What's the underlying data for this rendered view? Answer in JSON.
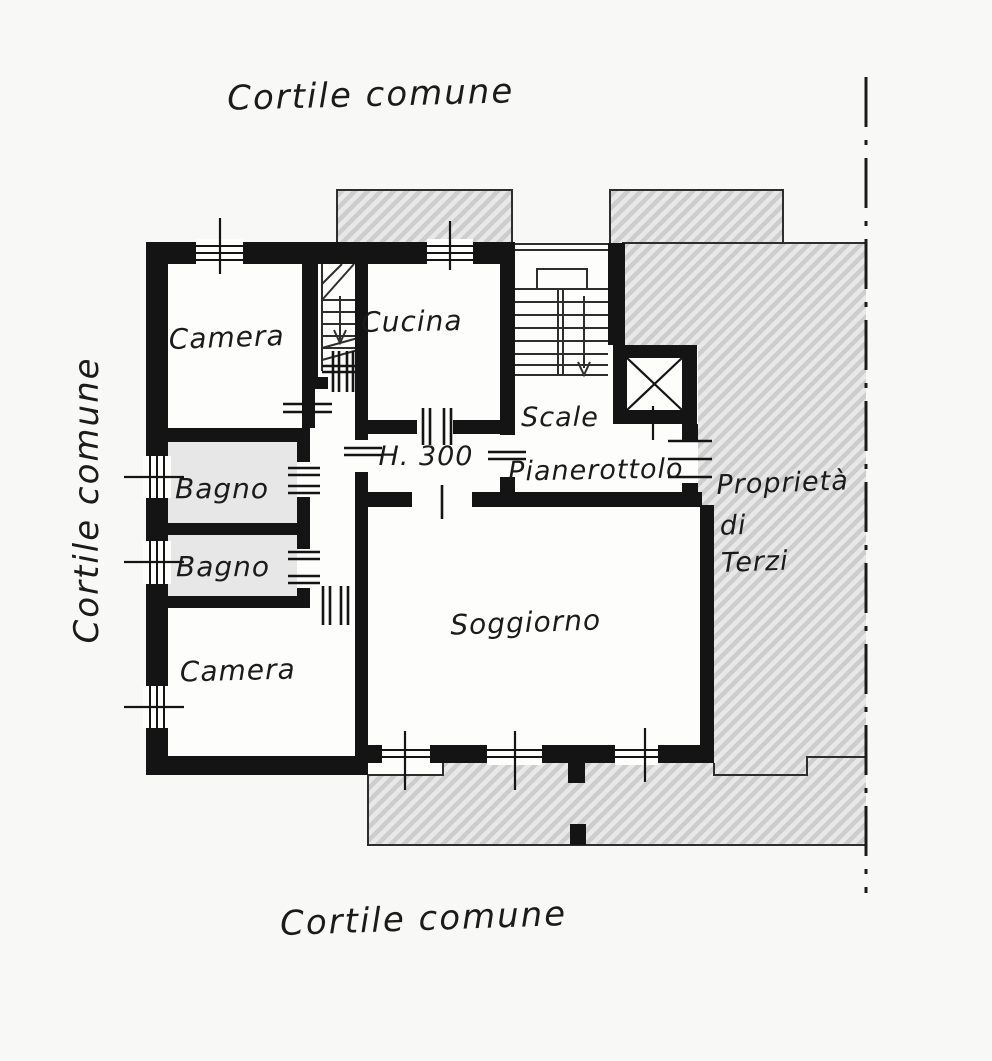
{
  "labels": {
    "cortile_top": "Cortile comune",
    "cortile_left": "Cortile comune",
    "cortile_bottom": "Cortile comune",
    "camera_top": "Camera",
    "cucina": "Cucina",
    "bagno_top": "Bagno",
    "bagno_bottom": "Bagno",
    "camera_bottom": "Camera",
    "soggiorno": "Soggiorno",
    "scale": "Scale",
    "pianerottolo": "Pianerottolo",
    "height_note": "H. 300",
    "neighbor_property": [
      "Proprietà",
      "di",
      "Terzi"
    ]
  },
  "colors": {
    "wall": "#141414",
    "paper": "#f8f8f6",
    "room": "#fdfdfc",
    "hatch_bg": "#e8e8e8",
    "hatch_stripe": "#cdcdcd",
    "bagno_fill": "#e7e7e7",
    "ink": "#1b1b1b",
    "thin_line": "#2e2e2e"
  }
}
